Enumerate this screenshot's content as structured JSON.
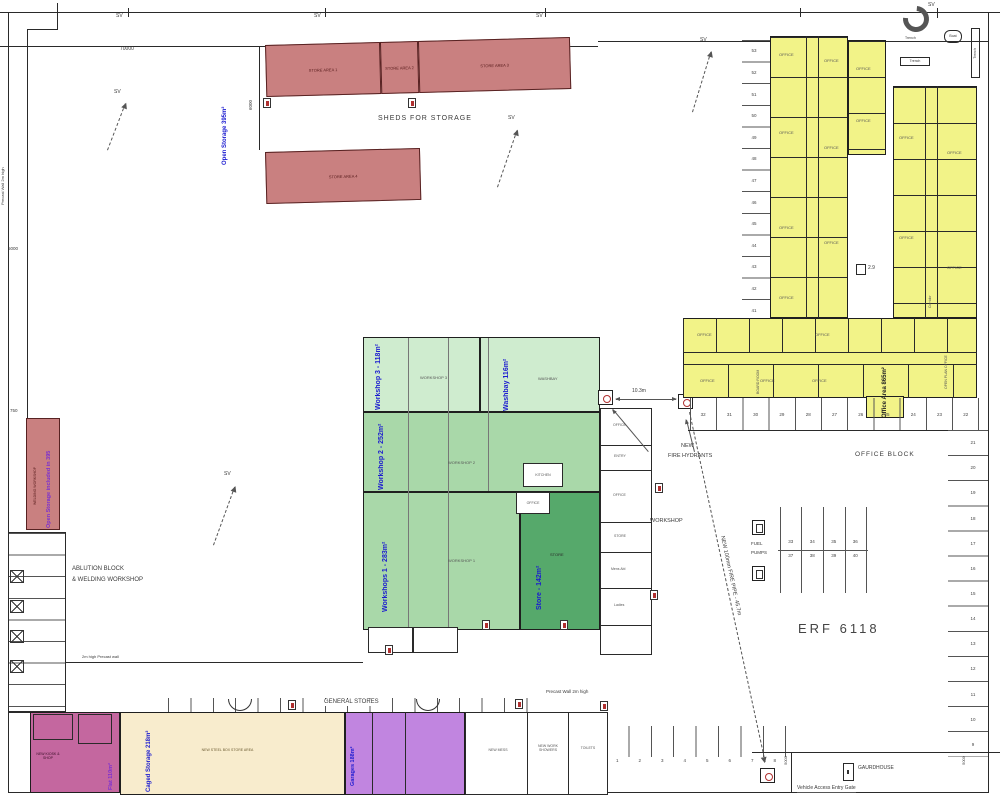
{
  "colors": {
    "shed_fill": "#c98080",
    "office_fill": "#f2f388",
    "workshop_pale": "#cfeccf",
    "workshop_mid": "#a9d8a9",
    "store_dark": "#56a96b",
    "garage_purple": "#c185e0",
    "flat_pink": "#c4679f",
    "caged_cream": "#f8eccd",
    "zone_label_blue": "#1a1ad0",
    "zone_label_purple": "#7a2fd0"
  },
  "texts": {
    "sv": "SV",
    "d70000": "70000",
    "d6000": "6000",
    "d5000": "5000",
    "d750": "750",
    "d103": "10.3m",
    "d29": "2.9",
    "sheds_for_storage": "SHEDS FOR STORAGE",
    "store_area_1": "STORE AREA 1",
    "store_area_2": "STORE AREA 2",
    "store_area_3": "STORE AREA 3",
    "store_area_4": "STORE AREA 4",
    "open_storage": "Open Storage 395m²",
    "open_storage_included": "Open Storage included in 395",
    "welding_workshop": "WELDING WORKSHOP",
    "ablution_1": "ABLUTION BLOCK",
    "ablution_2": "& WELDING WORKSHOP",
    "precast_wall_left": "Precast Wall 2m high",
    "precast_wall_mid": "2m high Precast wall",
    "precast_wall_bottom": "Precast Wall 2m high",
    "workshop3": "Workshop 3 - 118m²",
    "washbay": "Washbay 116m²",
    "workshop2": "Workshop 2 - 252m²",
    "workshop1": "Workshops 1 - 283m²",
    "store_zone": "Store - 142m²",
    "r_workshop3": "WORKSHOP 3",
    "r_washbay": "WASHBAY",
    "r_workshop2": "WORKSHOP 2",
    "r_workshop1": "WORKSHOP 1",
    "r_store": "STORE",
    "r_kitchen": "KITCHEN",
    "r_office": "OFFICE",
    "r_entry": "ENTRY",
    "r_mens": "Mens Abl",
    "r_ladies": "Ladies",
    "workshop_small": "WORKSHOP",
    "general_stores": "GENERAL STORES",
    "flat": "Flat 110m²",
    "caged_storage": "Caged Storage 218m²",
    "garages": "Garages 188m²",
    "new_kiosk": "NEW KIOSK & SHOP",
    "steel_box": "NEW STEEL BOX STORE AREA",
    "new_mess": "NEW MESS",
    "new_work_showers": "NEW WORK SHOWERS",
    "toilets": "TOILETS",
    "office_area": "Office Area 865m²",
    "office_block": "OFFICE BLOCK",
    "open_plan_office": "OPEN PLAN OFFICE",
    "board_room": "BOARD ROOM",
    "corridor": "Corridor",
    "erf": "ERF 6118",
    "new_hydrants_1": "NEW",
    "new_hydrants_2": "FIRE HYDRANTS",
    "fire_pipe": "NEW 100mm FIRE PIPE - 45.7m",
    "fuel_1": "FUEL",
    "fuel_2": "PUMPS",
    "gaurdhouse": "GAURDHOUSE",
    "vehicle_gate": "Vehicle Access Entry Gate",
    "trench": "Trench",
    "boat": "Boat"
  },
  "parking": {
    "left_col": [
      "53",
      "52",
      "51",
      "50",
      "49",
      "48",
      "47",
      "46",
      "45",
      "44",
      "43",
      "42",
      "41"
    ],
    "office_row": [
      "32",
      "31",
      "30",
      "29",
      "28",
      "27",
      "26",
      "25",
      "24",
      "23",
      "22"
    ],
    "right_col": [
      "21",
      "20",
      "19",
      "18",
      "17",
      "16",
      "15",
      "14",
      "13",
      "12",
      "11",
      "10",
      "9"
    ],
    "bottom_row": [
      "1",
      "2",
      "3",
      "4",
      "5",
      "6",
      "7",
      "8"
    ],
    "fuel_top": [
      "33",
      "34",
      "35",
      "36"
    ],
    "fuel_bottom": [
      "37",
      "38",
      "39",
      "40"
    ]
  }
}
